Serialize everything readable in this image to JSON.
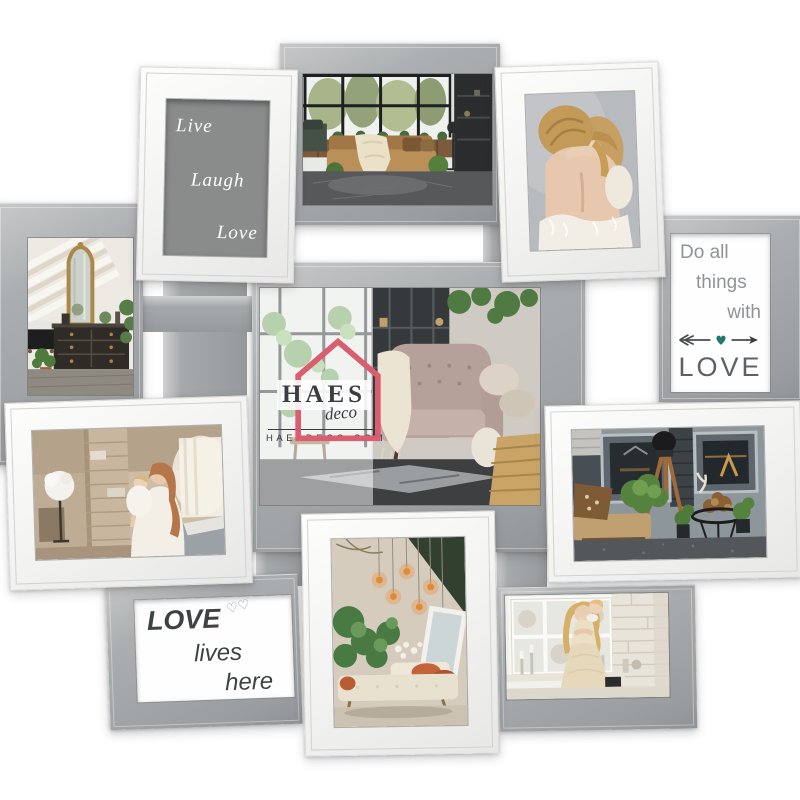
{
  "product": {
    "description": "Wall photo collage with eleven white and silver-gray frames on a white background",
    "background_color": "#ffffff",
    "white_frame_color": "#f5f5f4",
    "silver_frame_color": "#a7aaac"
  },
  "watermark": {
    "brand": "HAES",
    "brand_script": "deco",
    "website": "HAESDECO.COM",
    "house_color": "#d95e6f",
    "text_color": "#3b3b42"
  },
  "text_frames": {
    "live_laugh_love": {
      "words": [
        "Live",
        "Laugh",
        "Love"
      ],
      "mat_color": "#8a8b8b",
      "text_color": "#ffffff"
    },
    "do_all_things": {
      "lines": [
        "Do all",
        "things",
        "with"
      ],
      "word_love": "LOVE",
      "text_color": "#8f9497",
      "love_color": "#5d6164",
      "heart_color": "#1f7a6e"
    },
    "love_lives_here": {
      "word_love": "LOVE",
      "hearts": "♡♡",
      "word_lives": "lives",
      "word_here": "here",
      "text_color": "#3f4243"
    }
  },
  "photo_frames": [
    {
      "id": "top-living-room",
      "frame": "silver",
      "scene": "loft lounge with black grid window and daybed"
    },
    {
      "id": "mother-daughter-hug",
      "frame": "white",
      "scene": "mother hugging young daughter"
    },
    {
      "id": "mirror-room",
      "frame": "silver",
      "scene": "vintage room with gold mirror and black tub"
    },
    {
      "id": "center-armchair",
      "frame": "silver",
      "scene": "living room with velvet armchair and plants"
    },
    {
      "id": "mother-child-brick",
      "frame": "white",
      "scene": "mother holding child by brick column"
    },
    {
      "id": "tripod-bench",
      "frame": "white",
      "scene": "gray paneled wall with wooden tripod and bench"
    },
    {
      "id": "greenhouse-sofa",
      "frame": "white",
      "scene": "plant corner with hanging bulbs and daybed"
    },
    {
      "id": "window-family",
      "frame": "silver",
      "scene": "woman with child at bright window"
    }
  ]
}
